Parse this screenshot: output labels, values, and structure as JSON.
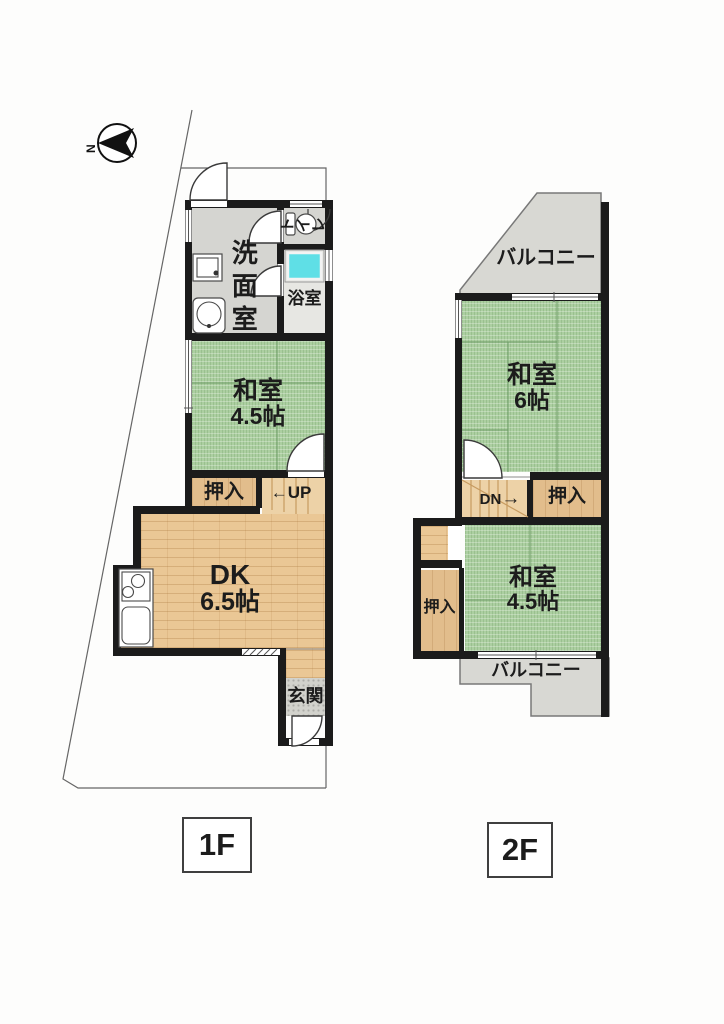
{
  "compass": {
    "north_label": "N"
  },
  "floor1": {
    "label": "1F",
    "washroom": "洗面室",
    "toilet_chars": {
      "c1": "ト",
      "c2": "イ",
      "c3": "レ"
    },
    "bathroom": "浴室",
    "tatami_name": "和室",
    "tatami_size": "4.5帖",
    "closet": "押入",
    "stairs_arrow": "←",
    "stairs_text": "UP",
    "dk_name": "DK",
    "dk_size": "6.5帖",
    "entrance": "玄関"
  },
  "floor2": {
    "label": "2F",
    "balcony_top": "バルコニー",
    "tatami6_name": "和室",
    "tatami6_size": "6帖",
    "stairs_text": "DN",
    "stairs_arrow": "→",
    "closet_right": "押入",
    "closet_left": "押入",
    "tatami45_name": "和室",
    "tatami45_size": "4.5帖",
    "balcony_bottom": "バルコニー"
  },
  "colors": {
    "wall": "#1b1b1b",
    "tatami": "#accfa1",
    "tatami-line": "#6f9e68",
    "wood": "#eac795",
    "wood-line": "#c79b60",
    "closet": "#e2bd8c",
    "stair": "#edd2a7",
    "gray-floor": "#dcdcd7",
    "balcony": "#d8d8d3",
    "tub": "#5fdfe6",
    "bound": "#666666",
    "door-stroke": "#3a3a3a"
  }
}
